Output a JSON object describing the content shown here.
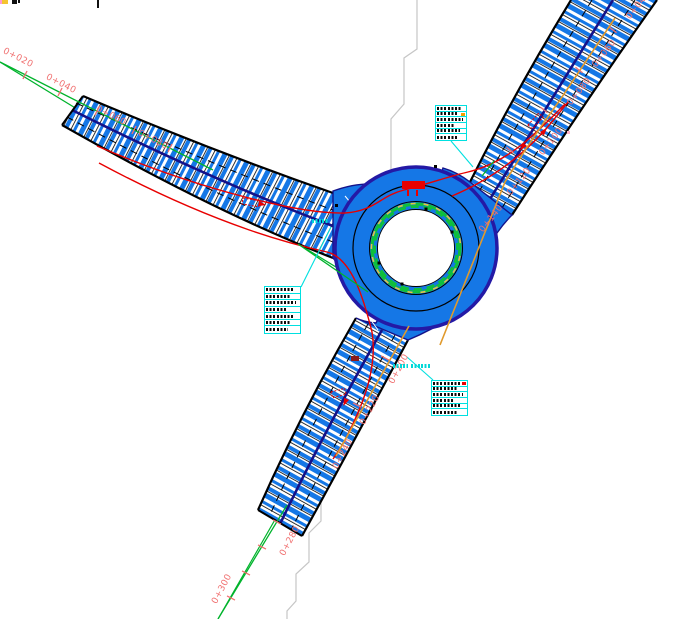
{
  "title": "roundabout-design-plan",
  "colors": {
    "road_hatch_blue": "#1577E6",
    "ring_fill_blue": "#1577E6",
    "ring_edge_navy": "#2419A5",
    "lane_navy": "#141289",
    "axis_green": "#00B32C",
    "island_green": "#0FBF3C",
    "island_yellow": "#E2CC3A",
    "station_red": "#F07070",
    "marker_red": "#E80000",
    "utility_orange": "#E09A2D",
    "callout_cyan": "#00E0E0",
    "parcel_gray": "#C6C6C6",
    "background": "#FFFFFF"
  },
  "station_labels": [
    {
      "text": "0+020",
      "x": 17,
      "y": 60,
      "rot": 27
    },
    {
      "text": "0+040",
      "x": 60,
      "y": 86,
      "rot": 27
    },
    {
      "text": "0+060",
      "x": 110,
      "y": 118,
      "rot": 27
    },
    {
      "text": "0+080",
      "x": 152,
      "y": 142,
      "rot": 27
    },
    {
      "text": "0+040",
      "x": 640,
      "y": 7,
      "rot": -52
    },
    {
      "text": "0+060",
      "x": 606,
      "y": 55,
      "rot": -52
    },
    {
      "text": "0+080",
      "x": 581,
      "y": 93,
      "rot": -52
    },
    {
      "text": "0+100",
      "x": 553,
      "y": 143,
      "rot": -52
    },
    {
      "text": "0+120",
      "x": 521,
      "y": 183,
      "rot": -52
    },
    {
      "text": "0+140",
      "x": 493,
      "y": 220,
      "rot": -52
    },
    {
      "text": "0+200",
      "x": 401,
      "y": 370,
      "rot": -62
    },
    {
      "text": "0+220",
      "x": 372,
      "y": 411,
      "rot": -62
    },
    {
      "text": "0+240",
      "x": 345,
      "y": 455,
      "rot": -62
    },
    {
      "text": "0+280",
      "x": 292,
      "y": 542,
      "rot": -62
    },
    {
      "text": "0+300",
      "x": 224,
      "y": 590,
      "rot": -62
    }
  ],
  "callout_boxes": [
    {
      "id": "callout-top-right",
      "x": 435,
      "y": 105,
      "w": 32,
      "h": 36,
      "rows": 6,
      "accent": "#f4a000",
      "accent_row": 1
    },
    {
      "id": "callout-left",
      "x": 264,
      "y": 286,
      "w": 37,
      "h": 48,
      "rows": 7,
      "accent": null,
      "accent_row": -1
    },
    {
      "id": "callout-bottom",
      "x": 431,
      "y": 380,
      "w": 37,
      "h": 36,
      "rows": 6,
      "accent": "#e80000",
      "accent_row": 0
    }
  ],
  "smudge_widths_pct": [
    88,
    72,
    92,
    64,
    82,
    76,
    68
  ],
  "path_markers": [
    {
      "id": "swept-marker-left",
      "x": 243,
      "y": 198,
      "w": 17,
      "h": 6,
      "rot": 10
    },
    {
      "id": "swept-marker-right",
      "x": 528,
      "y": 125,
      "w": 16,
      "h": 6,
      "rot": -48
    },
    {
      "id": "swept-marker-bottom",
      "x": 331,
      "y": 392,
      "w": 14,
      "h": 6,
      "rot": -15
    }
  ]
}
